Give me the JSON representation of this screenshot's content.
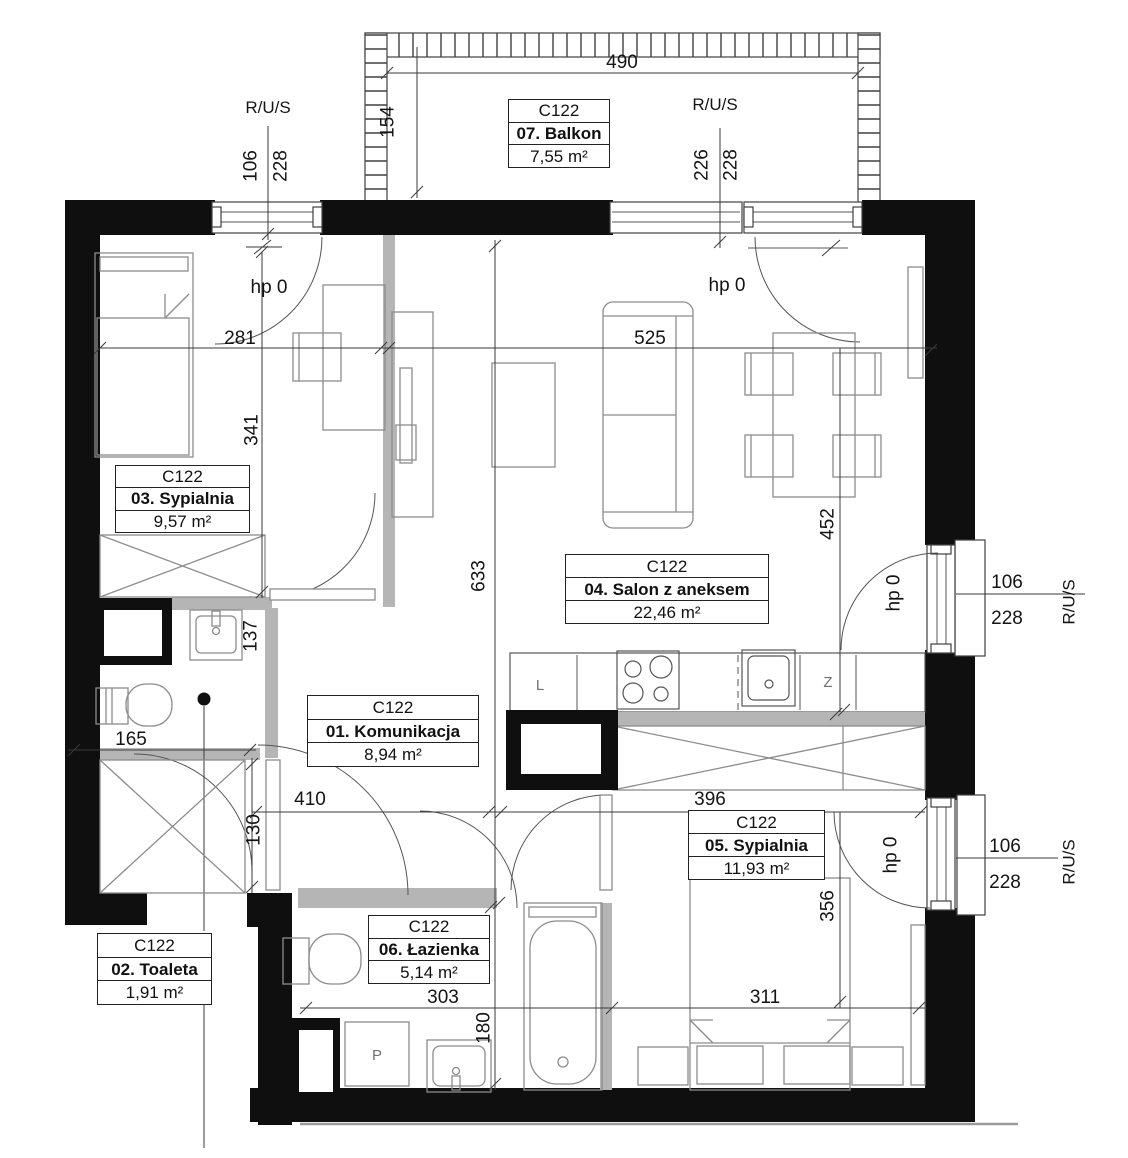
{
  "plan": {
    "unit_code": "C122",
    "rooms": [
      {
        "code": "C122",
        "name": "01. Komunikacja",
        "area": "8,94 m²"
      },
      {
        "code": "C122",
        "name": "02. Toaleta",
        "area": "1,91 m²"
      },
      {
        "code": "C122",
        "name": "03. Sypialnia",
        "area": "9,57 m²"
      },
      {
        "code": "C122",
        "name": "04. Salon z aneksem",
        "area": "22,46 m²"
      },
      {
        "code": "C122",
        "name": "05. Sypialnia",
        "area": "11,93 m²"
      },
      {
        "code": "C122",
        "name": "06. Łazienka",
        "area": "5,14 m²"
      },
      {
        "code": "C122",
        "name": "07. Balkon",
        "area": "7,55 m²"
      }
    ],
    "dimensions": {
      "balcony_width": "490",
      "balcony_depth": "154",
      "balcony_door_w": "226",
      "balcony_door_h": "228",
      "win_left_w": "106",
      "win_left_h": "228",
      "room3_width": "281",
      "room3_depth": "341",
      "salon_width": "525",
      "salon_depth": "452",
      "core_height": "633",
      "basin_wall": "137",
      "toalet_width": "165",
      "hall_width": "410",
      "hall_depth": "130",
      "kitchen_width": "396",
      "bath_width": "303",
      "bath_depth": "180",
      "room5_width": "311",
      "room5_depth": "356",
      "win_mid_w": "106",
      "win_mid_h": "228",
      "win_bot_w": "106",
      "win_bot_h": "228"
    },
    "annotations": {
      "rus": "R/U/S",
      "hp": "hp 0"
    },
    "appliances": {
      "fridge": "L",
      "dishwasher": "Z",
      "washer": "P"
    }
  }
}
